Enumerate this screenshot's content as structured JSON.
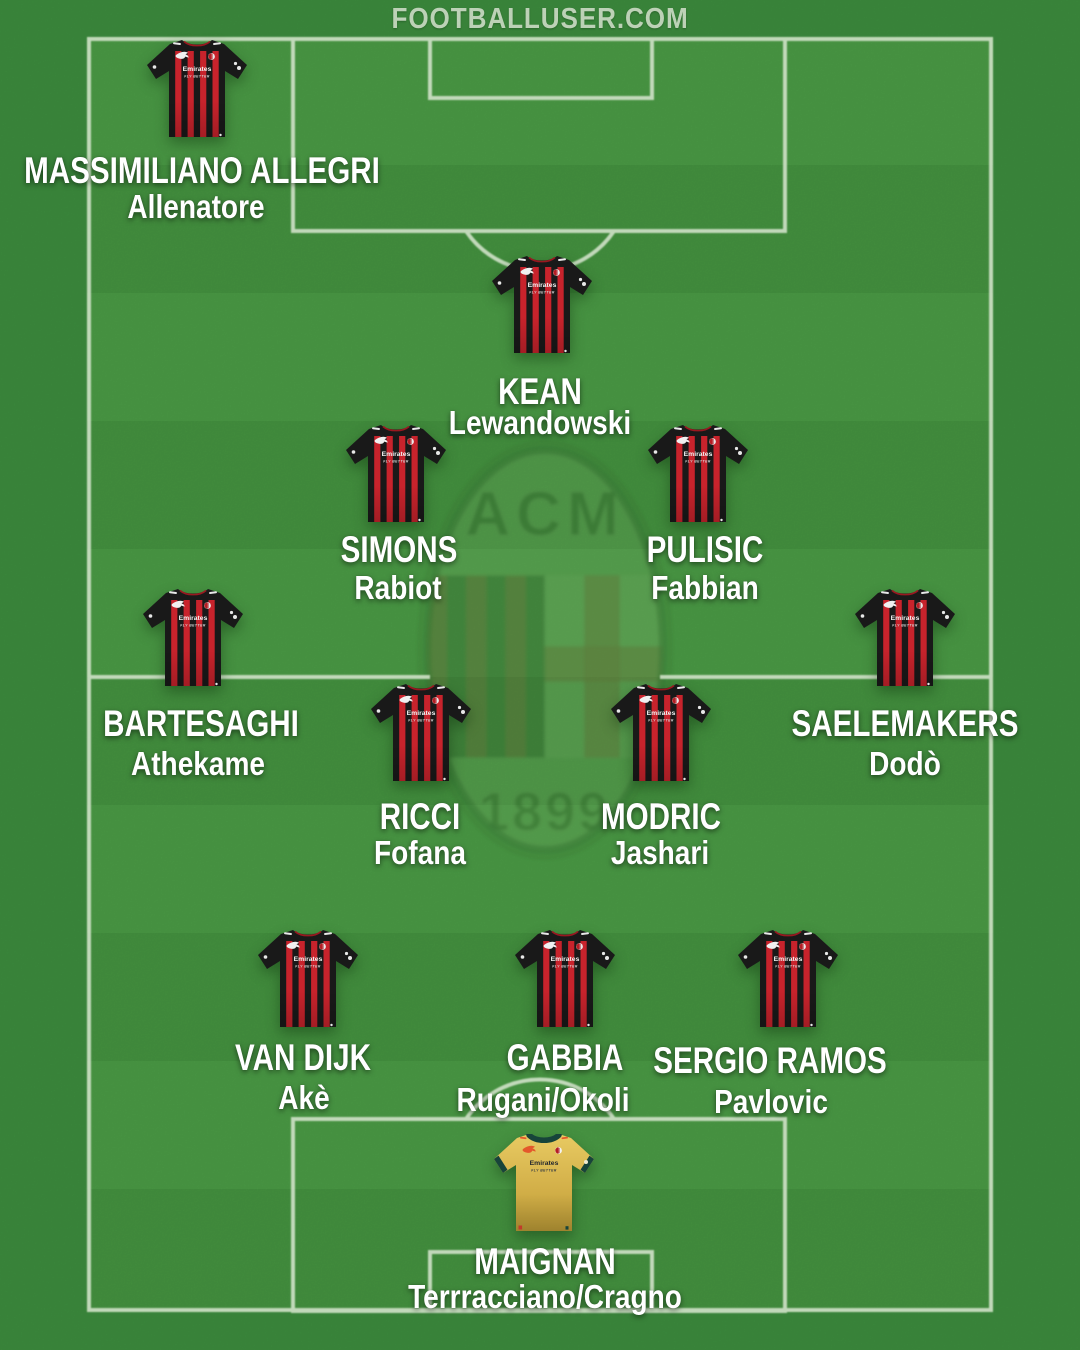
{
  "header": {
    "site": "FOOTBALLUSER.COM"
  },
  "club": {
    "abbr": "ACM",
    "founded": "1899",
    "sponsor": "Emirates",
    "sponsor_tagline": "FLY BETTER"
  },
  "colors": {
    "pitch_band_a": "#4a9a45",
    "pitch_band_b": "#44923f",
    "out_of_bounds": "#3c8b3d",
    "line": "#d4e4cc",
    "milan_red": "#c8232c",
    "kit_black": "#191919",
    "keeper_gold": "#d7b84a",
    "keeper_trim": "#17443a",
    "label_text": "#ffffff",
    "header_text": "#c9dfc3"
  },
  "players": [
    {
      "id": "allegri",
      "name": "MASSIMILIANO ALLEGRI",
      "sub": "Allenatore",
      "kit": "outfield",
      "jx": 197,
      "jy": 40,
      "nx": 202,
      "ny": 171,
      "sx": 196,
      "sy": 207
    },
    {
      "id": "kean",
      "name": "KEAN",
      "sub": "Lewandowski",
      "kit": "outfield",
      "jx": 542,
      "jy": 256,
      "nx": 540,
      "ny": 392,
      "sx": 540,
      "sy": 423
    },
    {
      "id": "simons",
      "name": "SIMONS",
      "sub": "Rabiot",
      "kit": "outfield",
      "jx": 396,
      "jy": 425,
      "nx": 399,
      "ny": 550,
      "sx": 398,
      "sy": 588
    },
    {
      "id": "pulisic",
      "name": "PULISIC",
      "sub": "Fabbian",
      "kit": "outfield",
      "jx": 698,
      "jy": 425,
      "nx": 705,
      "ny": 550,
      "sx": 705,
      "sy": 588
    },
    {
      "id": "bartesaghi",
      "name": "BARTESAGHI",
      "sub": "Athekame",
      "kit": "outfield",
      "jx": 193,
      "jy": 589,
      "nx": 201,
      "ny": 724,
      "sx": 198,
      "sy": 764
    },
    {
      "id": "saelemakers",
      "name": "SAELEMAKERS",
      "sub": "Dodò",
      "kit": "outfield",
      "jx": 905,
      "jy": 589,
      "nx": 905,
      "ny": 724,
      "sx": 905,
      "sy": 764
    },
    {
      "id": "ricci",
      "name": "RICCI",
      "sub": "Fofana",
      "kit": "outfield",
      "jx": 421,
      "jy": 684,
      "nx": 420,
      "ny": 817,
      "sx": 420,
      "sy": 853
    },
    {
      "id": "modric",
      "name": "MODRIC",
      "sub": "Jashari",
      "kit": "outfield",
      "jx": 661,
      "jy": 684,
      "nx": 661,
      "ny": 817,
      "sx": 660,
      "sy": 853
    },
    {
      "id": "van-dijk",
      "name": "VAN DIJK",
      "sub": "Akè",
      "kit": "outfield",
      "jx": 308,
      "jy": 930,
      "nx": 303,
      "ny": 1058,
      "sx": 304,
      "sy": 1098
    },
    {
      "id": "gabbia",
      "name": "GABBIA",
      "sub": "Rugani/Okoli",
      "kit": "outfield",
      "jx": 565,
      "jy": 930,
      "nx": 565,
      "ny": 1058,
      "sx": 543,
      "sy": 1100
    },
    {
      "id": "sergio-ramos",
      "name": "SERGIO RAMOS",
      "sub": "Pavlovic",
      "kit": "outfield",
      "jx": 788,
      "jy": 930,
      "nx": 770,
      "ny": 1061,
      "sx": 771,
      "sy": 1102
    },
    {
      "id": "maignan",
      "name": "MAIGNAN",
      "sub": "Terrracciano/Cragno",
      "kit": "keeper",
      "jx": 544,
      "jy": 1134,
      "nx": 545,
      "ny": 1262,
      "sx": 545,
      "sy": 1297
    }
  ]
}
